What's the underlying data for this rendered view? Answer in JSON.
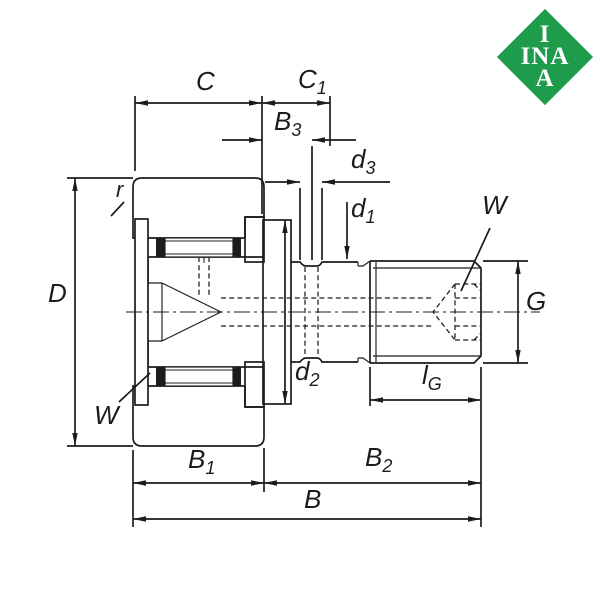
{
  "colors": {
    "line": "#1c1c1c",
    "background": "#ffffff"
  },
  "logo": {
    "line1": "I",
    "line2": "INA",
    "line3": "A",
    "background": "#1f9b4c",
    "text_color": "#ffffff"
  },
  "labels": {
    "C": {
      "main": "C",
      "sub": ""
    },
    "C1": {
      "main": "C",
      "sub": "1"
    },
    "B3": {
      "main": "B",
      "sub": "3"
    },
    "d3": {
      "main": "d",
      "sub": "3"
    },
    "d1": {
      "main": "d",
      "sub": "1"
    },
    "r": {
      "main": "r",
      "sub": ""
    },
    "D": {
      "main": "D",
      "sub": ""
    },
    "W_socket": {
      "main": "W",
      "sub": ""
    },
    "G": {
      "main": "G",
      "sub": ""
    },
    "lG": {
      "main": "l",
      "sub": "G"
    },
    "d2": {
      "main": "d",
      "sub": "2"
    },
    "B1": {
      "main": "B",
      "sub": "1"
    },
    "B2": {
      "main": "B",
      "sub": "2"
    },
    "B": {
      "main": "B",
      "sub": ""
    },
    "W_seal": {
      "main": "W",
      "sub": ""
    }
  }
}
